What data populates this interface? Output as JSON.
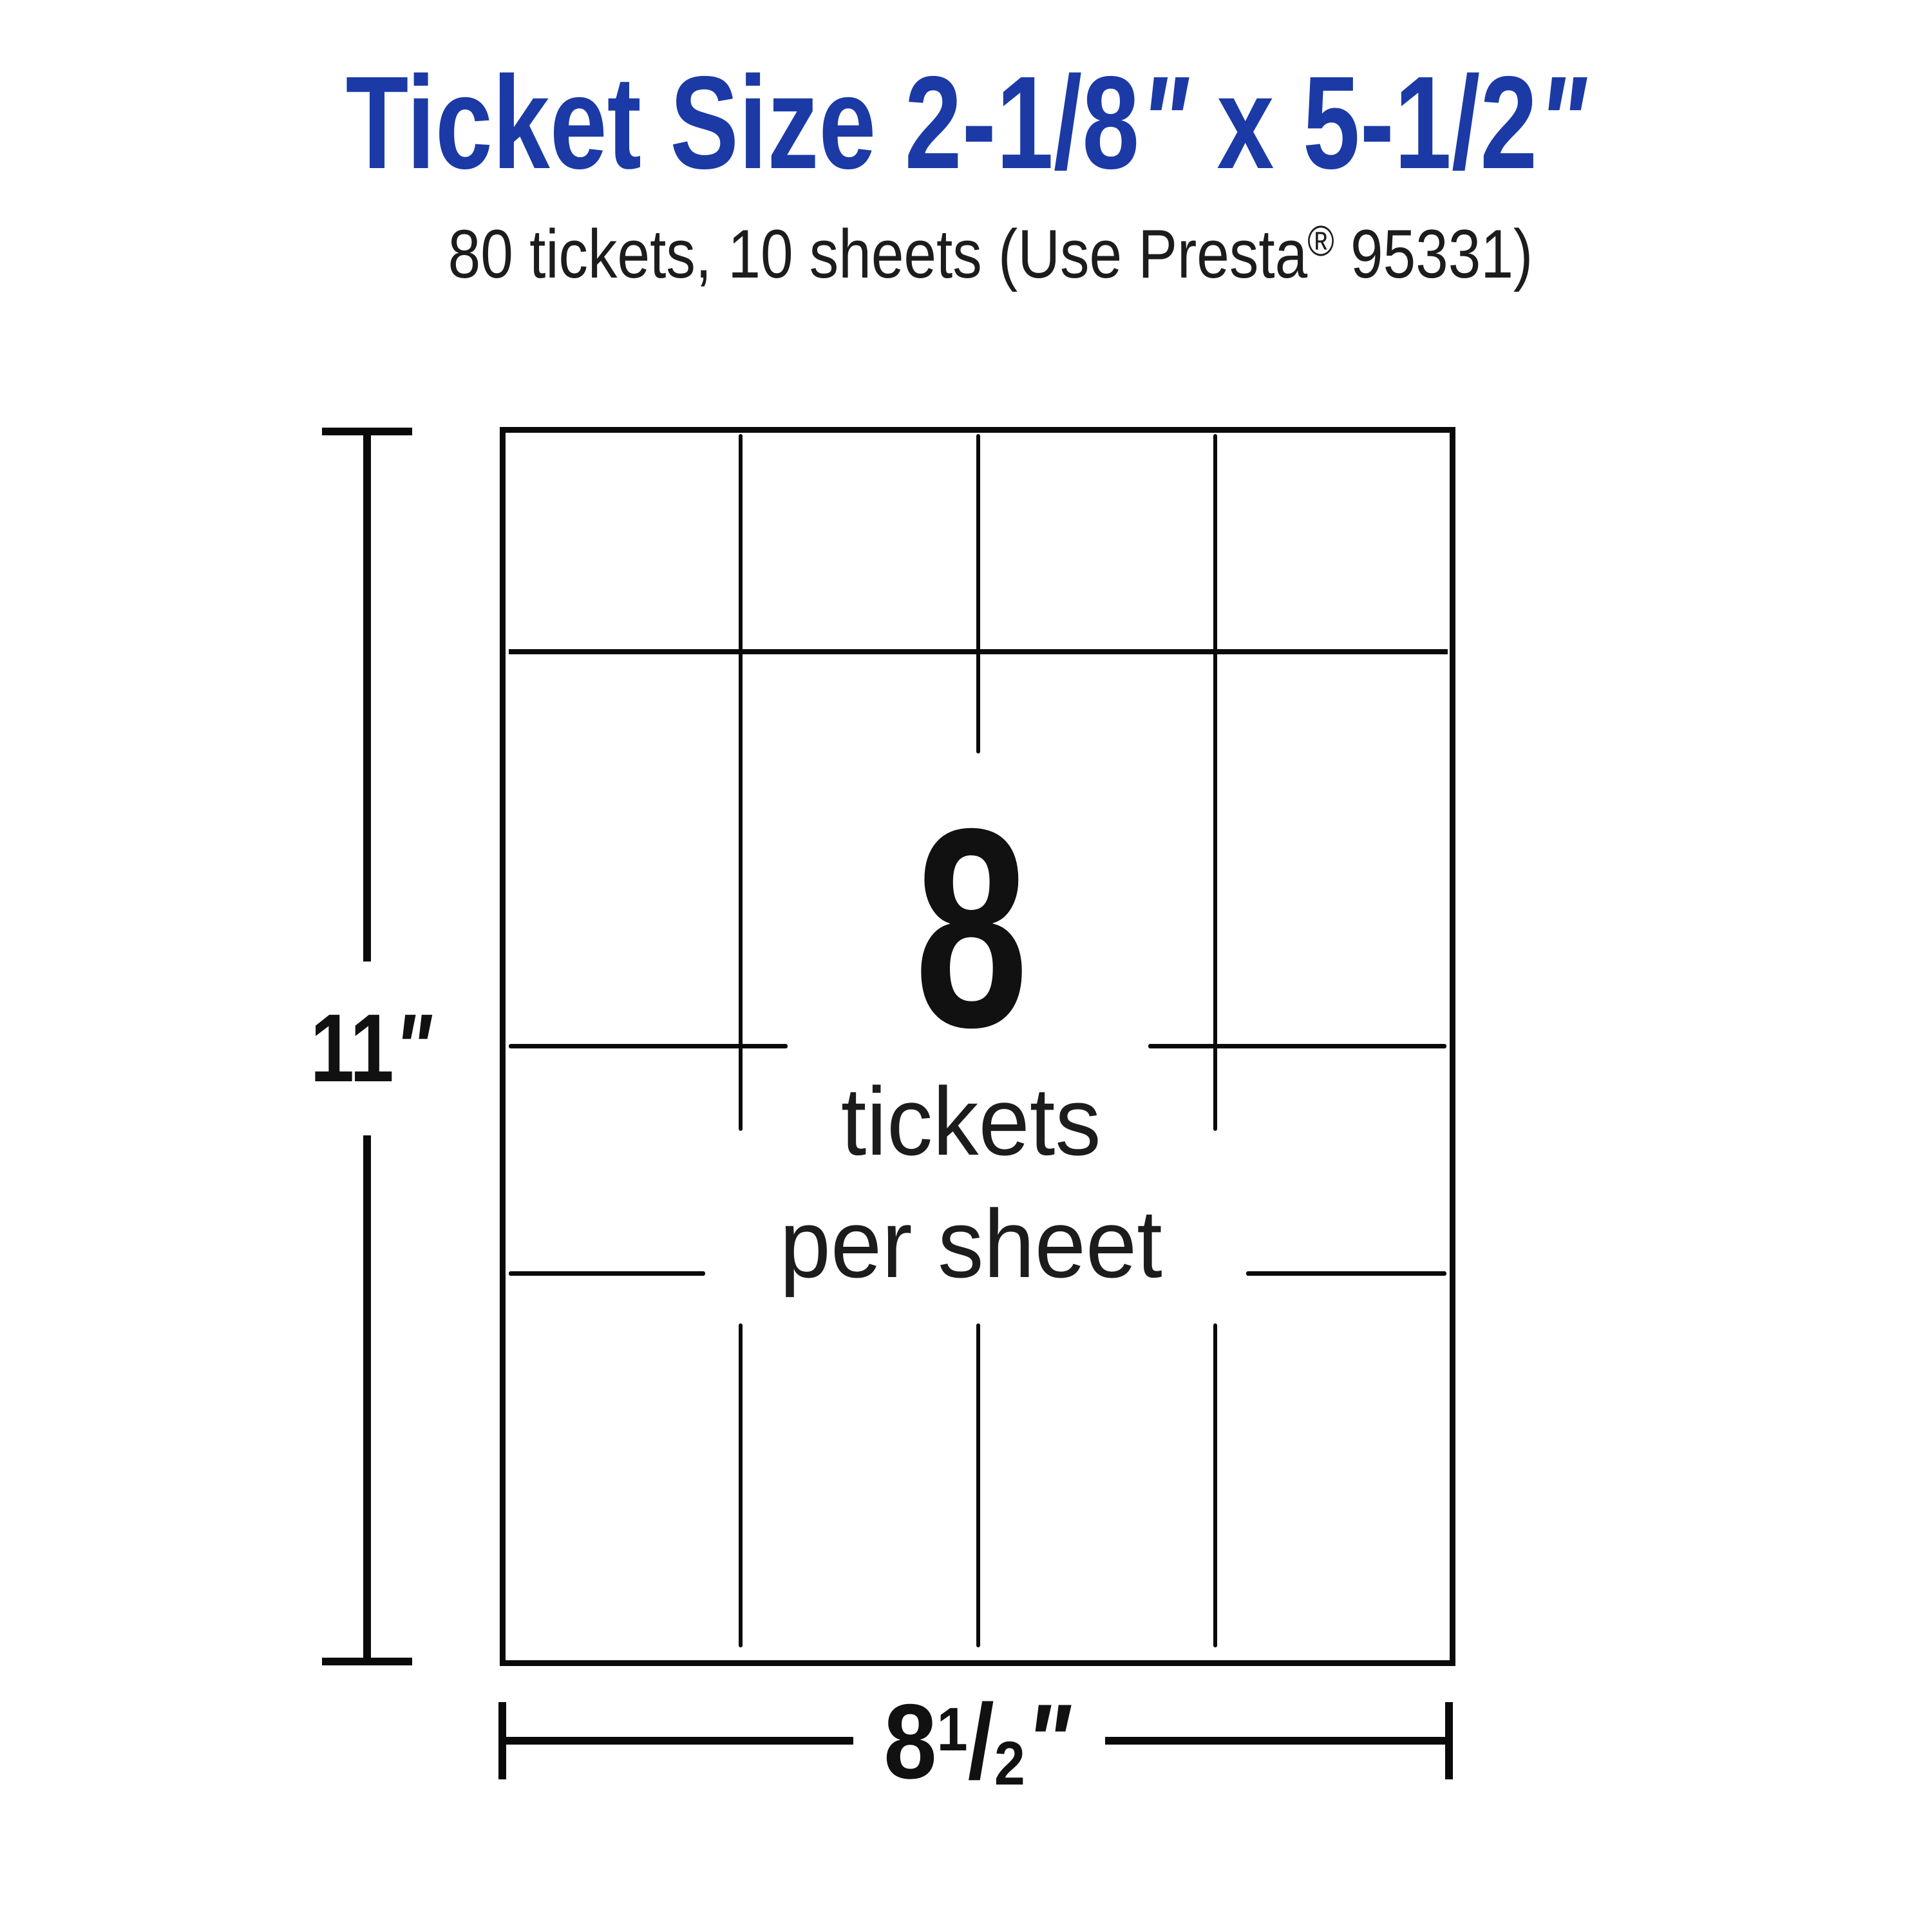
{
  "page": {
    "background_color": "#ffffff",
    "line_color": "#0a0a0a",
    "text_color": "#1c1c1c",
    "accent_blue": "#1b3aa6"
  },
  "title": {
    "part1": "Ticket Size 2-1/8",
    "prime1": "\"",
    "part2": " x 5-1/2",
    "prime2": "\""
  },
  "subtitle": {
    "part1": "80 tickets, 10 sheets (Use Presta",
    "registered_mark": "®",
    "part2": " 95331)"
  },
  "sheet": {
    "count": "8",
    "caption_line1": "tickets",
    "caption_line2": "per sheet"
  },
  "dimensions": {
    "height": {
      "value": "11",
      "unit_mark": "\""
    },
    "width": {
      "whole": "8",
      "numerator": "1",
      "slash": "/",
      "denominator": "2",
      "unit_mark": "\""
    }
  }
}
